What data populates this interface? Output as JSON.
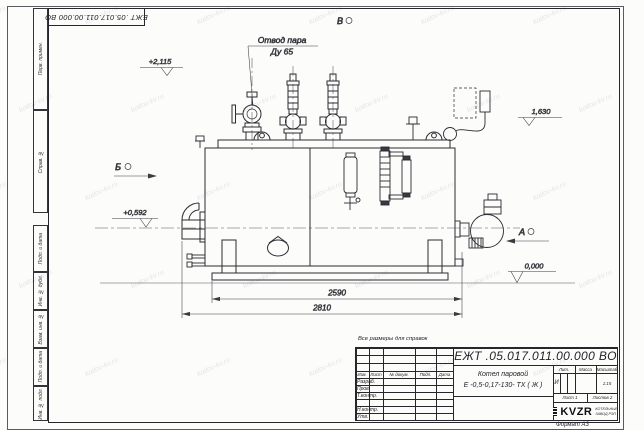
{
  "sheet": {
    "stamp_top": "ЕЖТ .05.017.011.00.000  ВО",
    "reference_note": "Все размеры для справок",
    "format_note": "Формат А3",
    "watermark": "kotlov-kv.ru",
    "margin_labels": [
      "Перв. примен.",
      "Справ. №",
      "Подп. и дата",
      "Инв. № дубл.",
      "Взам. инв. №",
      "Подп. и дата",
      "Инв. № подл."
    ]
  },
  "drawing": {
    "callout_line1": "Отвод пара",
    "callout_line2": "Ду 65",
    "views": {
      "top": "В",
      "left": "Б",
      "right": "А"
    },
    "levels": {
      "top": "+2,115",
      "upper_right": "1,630",
      "burner": "+0,592",
      "ground": "0,000"
    },
    "dims": {
      "skid": "2590",
      "overall": "2810"
    }
  },
  "titleblock": {
    "doc_number": "ЕЖТ .05.017.011.00.000  ВО",
    "product_name_line1": "Котел паровой",
    "product_name_line2": "Е -0,5-0,17-130- ТХ ( Ж )",
    "header": {
      "izm": "Изм.",
      "list": "Лист",
      "doc": "№ докум.",
      "podp": "Подп.",
      "data": "Дата"
    },
    "rows": [
      "Разраб.",
      "Пров.",
      "Т.контр.",
      "",
      "Н.контр.",
      "Утв."
    ],
    "lit_header": "Лит.",
    "mass_header": "Масса",
    "scale_header": "Масштаб",
    "lit_value": "И",
    "scale_value": "1:15",
    "sheet_label": "Лист 1",
    "sheets_label": "Листов 2",
    "company": {
      "logo_text": "KVZR",
      "name_line1": "КОТЕЛЬНЫЙ",
      "name_line2": "ЗАВОД РЭП"
    }
  }
}
